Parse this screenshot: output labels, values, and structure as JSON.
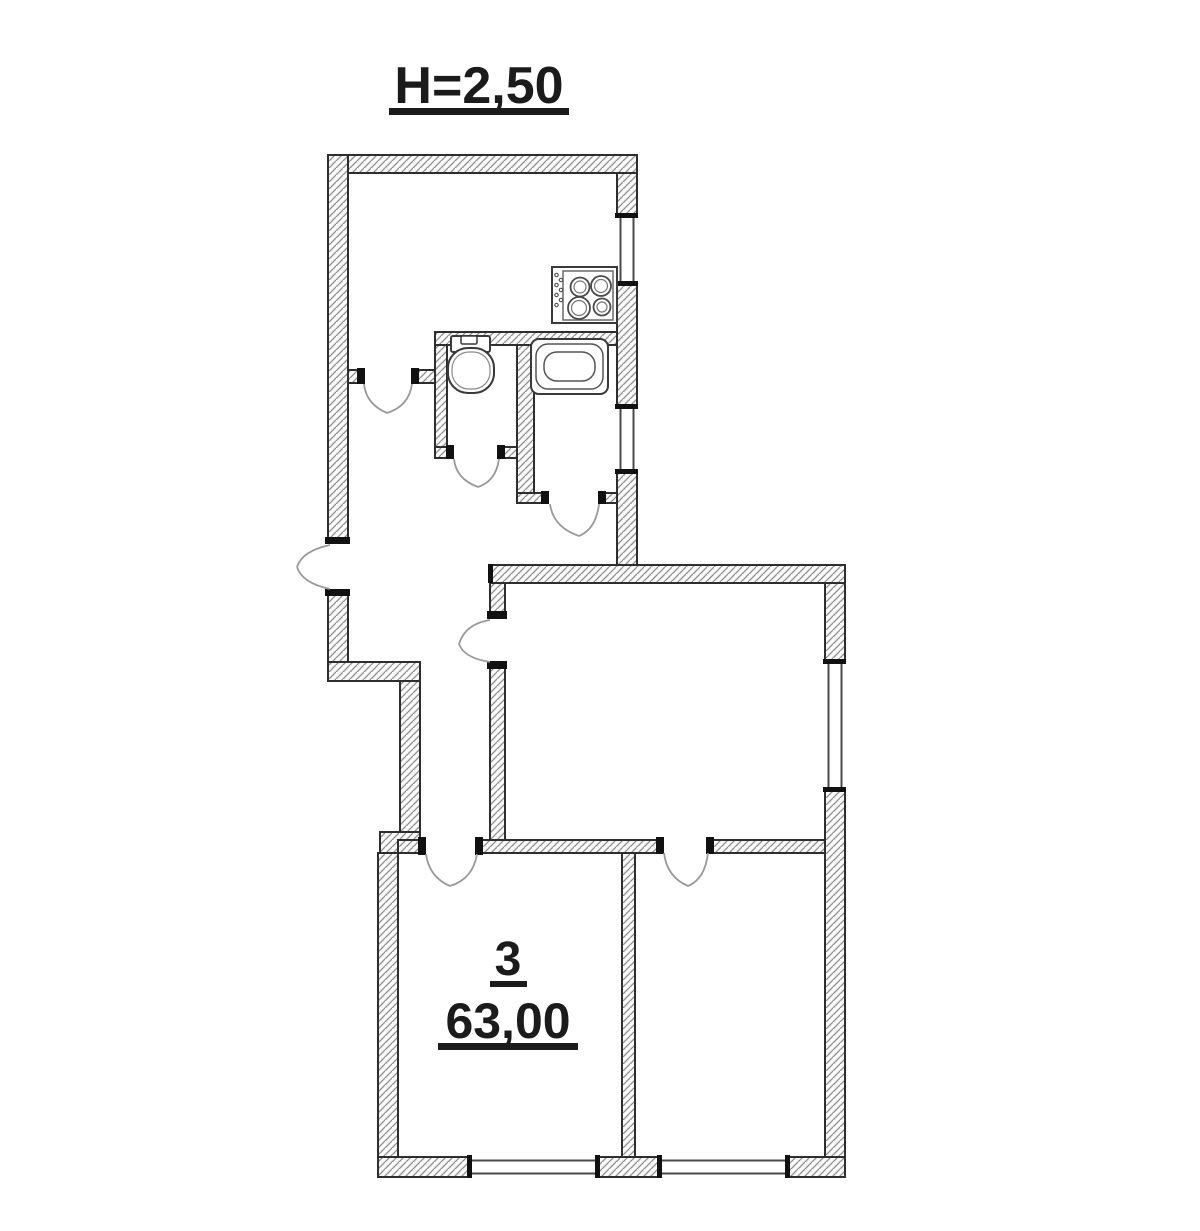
{
  "plan": {
    "ceiling_height_label": "Н=2,50",
    "room": {
      "number": "3",
      "area": "63,00"
    },
    "fixtures": [
      {
        "icon": "stove-icon"
      },
      {
        "icon": "toilet-icon"
      },
      {
        "icon": "bathtub-icon"
      }
    ],
    "colors": {
      "background": "#ffffff",
      "wall_outline": "#2e2e2e",
      "wall_hatch": "#8d8d8d",
      "jamb": "#111111",
      "door_swing": "#999999",
      "text": "#1b1b1b"
    }
  }
}
